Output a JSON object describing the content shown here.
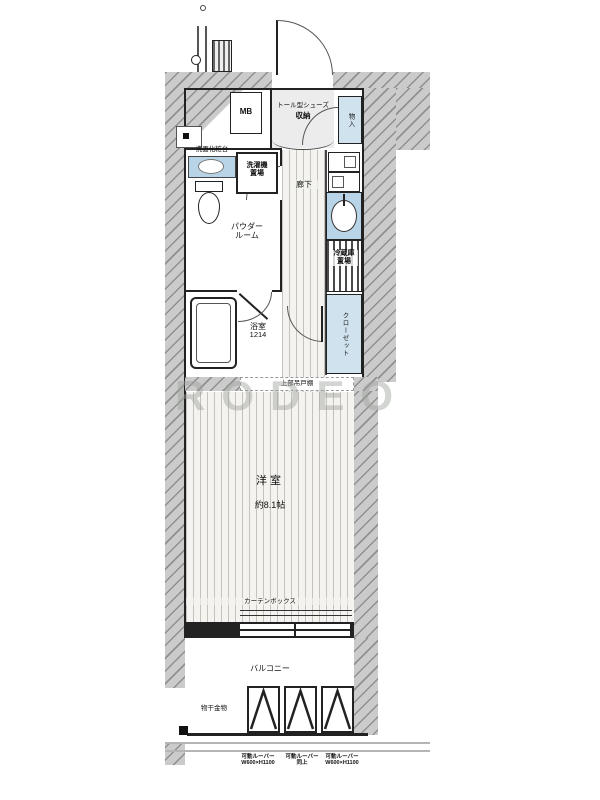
{
  "watermark": "RODEO",
  "labels": {
    "meter_box": "MB",
    "shoe_storage_line1": "トール型シューズ",
    "shoe_storage_line2": "収納",
    "small_storage": "物入",
    "vanity": "洗面化粧台",
    "washer_line1": "洗濯機",
    "washer_line2": "置場",
    "powder_line1": "パウダー",
    "powder_line2": "ルーム",
    "hallway": "廊下",
    "bath_line1": "浴室",
    "bath_line2": "1214",
    "fridge_line1": "冷蔵庫",
    "fridge_line2": "置場",
    "closet": "クローゼット",
    "cupboard_note": "上部吊戸棚",
    "room_name": "洋室",
    "room_size": "約8.1帖",
    "curtain_box": "カーテンボックス",
    "balcony": "バルコニー",
    "laundry_bracket": "物干金物",
    "louvers": [
      {
        "l1": "可動ルーバー",
        "l2": "W600×H1100"
      },
      {
        "l1": "可動ルーバー",
        "l2": "同上"
      },
      {
        "l1": "可動ルーバー",
        "l2": "W600×H1100"
      }
    ]
  }
}
